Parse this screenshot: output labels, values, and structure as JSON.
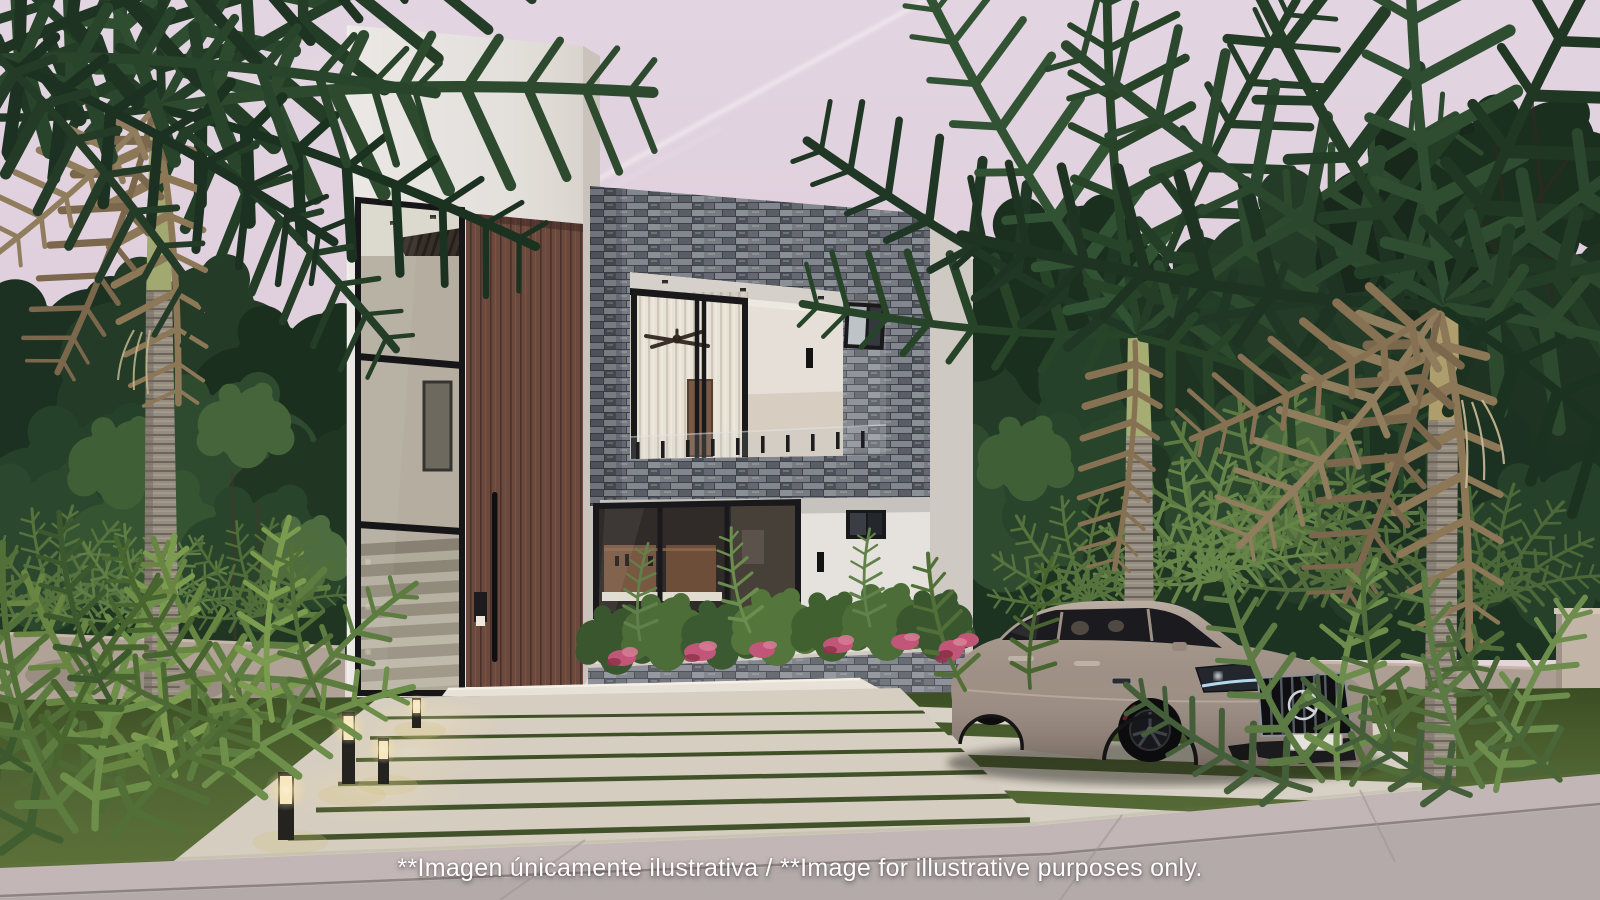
{
  "disclaimer": {
    "text": "**Imagen únicamente ilustrativa / **Image for illustrative purposes only."
  },
  "scene": {
    "type": "3D exterior architectural rendering of a modern two-story house",
    "time_of_day": "dusk with pale pink-lavender sky and a jet contrail",
    "house": {
      "stories": 2,
      "volumes": [
        "tall white stucco entry tower with full-height black-framed stair glazing",
        "vertical wood-slat entry door with long black pull handle and keypad",
        "gray ledgestone-clad upper volume with recessed balcony opening"
      ],
      "details": [
        "frameless glass balcony railing with black posts",
        "ceiling fan on balcony",
        "white sheer curtains behind sliding glass doors",
        "black-framed accent windows",
        "recessed ceiling downlights",
        "black wall sconces",
        "ledgestone planter with green shrubs and pink caladiums",
        "interior staircase and kitchen visible through glazing"
      ]
    },
    "vehicle": {
      "type": "sedan",
      "emblem": "Mercedes-Benz three-pointed star",
      "color_name": "greige / taupe",
      "details": [
        "black multi-spoke wheels",
        "black vertical-slat grille",
        "lit headlights with blue DRL",
        "blank white license plate"
      ]
    },
    "landscape": [
      "coconut palm trees with dry hanging fronds",
      "dense tropical jungle backdrop",
      "low beige perimeter walls",
      "lawn parking pad with white concrete strips",
      "wide paver walkway to the entry",
      "glowing bollard path lights",
      "ferns and spiky rosette palms"
    ],
    "foreground": "concrete sidewalk and street with expansion joints"
  },
  "palette": {
    "sky_top": "#e9dbe7",
    "sky_mid": "#e7d6e2",
    "sky_horizon": "#f3e2e2",
    "contrail": "#ffffff",
    "jungle_dark": "#1c3320",
    "jungle_mid": "#27452a",
    "palm_green": "#2a482c",
    "palm_dry": "#8f7a57",
    "fern_green": "#6a8a42",
    "lawn": "#556c34",
    "paver": "#ded8cb",
    "walkway": "#dcd5c6",
    "road_sidewalk": "#c7bdbb",
    "road_street": "#b8afad",
    "wall_left": "#b5a79a",
    "wall_right": "#b1a396",
    "wall_pillar": "#c7baab",
    "stucco": "#eceae4",
    "stucco_side": "#d5d0c8",
    "wood_door": "#6d4a3d",
    "glass_frame": "#17181a",
    "handle_black": "#0e0f10",
    "curtain": "#efe9dc",
    "car_body": "#a29488",
    "car_glass": "#191b1e",
    "headlight_drl": "#bfe9ff",
    "plant_pink": "#c7587a",
    "bollard_glow": "#ffeab0",
    "text_white": "#ffffff"
  }
}
